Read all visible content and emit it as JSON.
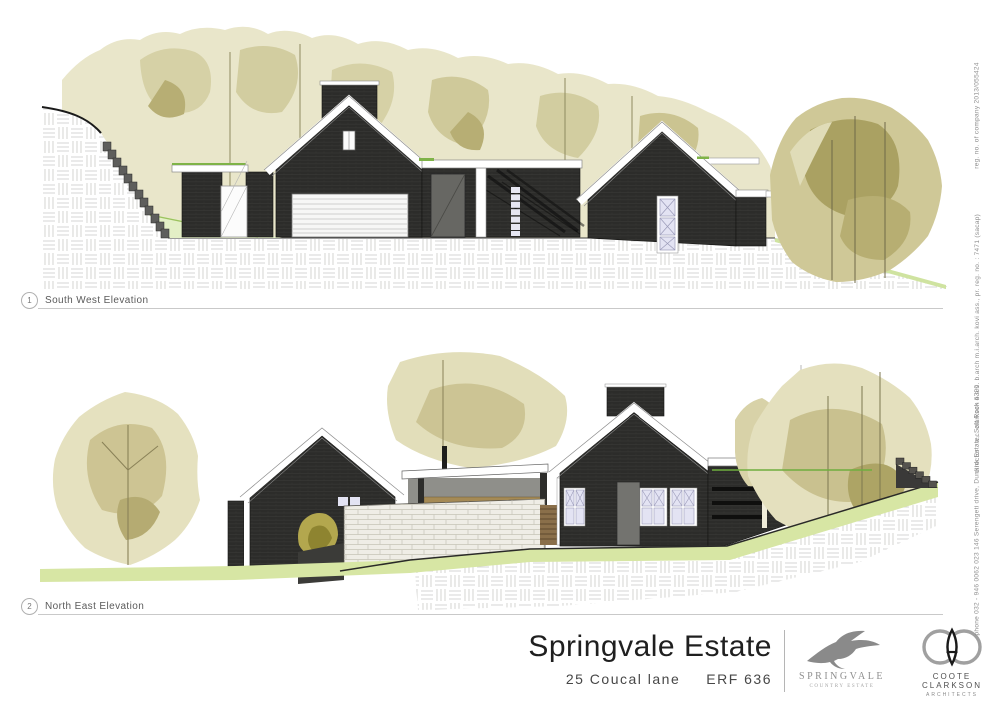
{
  "sheet": {
    "elevations": [
      {
        "number": "1",
        "label": "South West Elevation"
      },
      {
        "number": "2",
        "label": "North East Elevation"
      }
    ],
    "title_block": {
      "project_title": "Springvale Estate",
      "address": "25 Coucal lane",
      "erf": "ERF 636"
    },
    "logos": {
      "springvale": {
        "name": "SPRINGVALE",
        "subtitle": "COUNTRY ESTATE"
      },
      "coote_clarkson": {
        "name": "COOTE CLARKSON",
        "subtitle": "ARCHITECTS"
      }
    },
    "margin_notes": {
      "company_reg": "reg. no. of company 2013/055424",
      "directors": "director : a.c. clarkson  b.a.s.  b.arch  m.i.arch.  kovi ass.,  pr. reg. no. : 7471 (sacap)",
      "contact": "phone 032 - 946 0062 023    146 Serengeti drive, Dunkirk Estate, Salt Rock 4390"
    },
    "colors": {
      "house_dark": "#2c2c2a",
      "tree_light": "#e9e6ca",
      "tree_mid": "#d2cda0",
      "tree_dark": "#aaa162",
      "grass": "#d7e6a4",
      "window_glass": "#e3e3f3",
      "accent_green": "#7fb348",
      "logo_gray": "#8a8a8a"
    }
  }
}
